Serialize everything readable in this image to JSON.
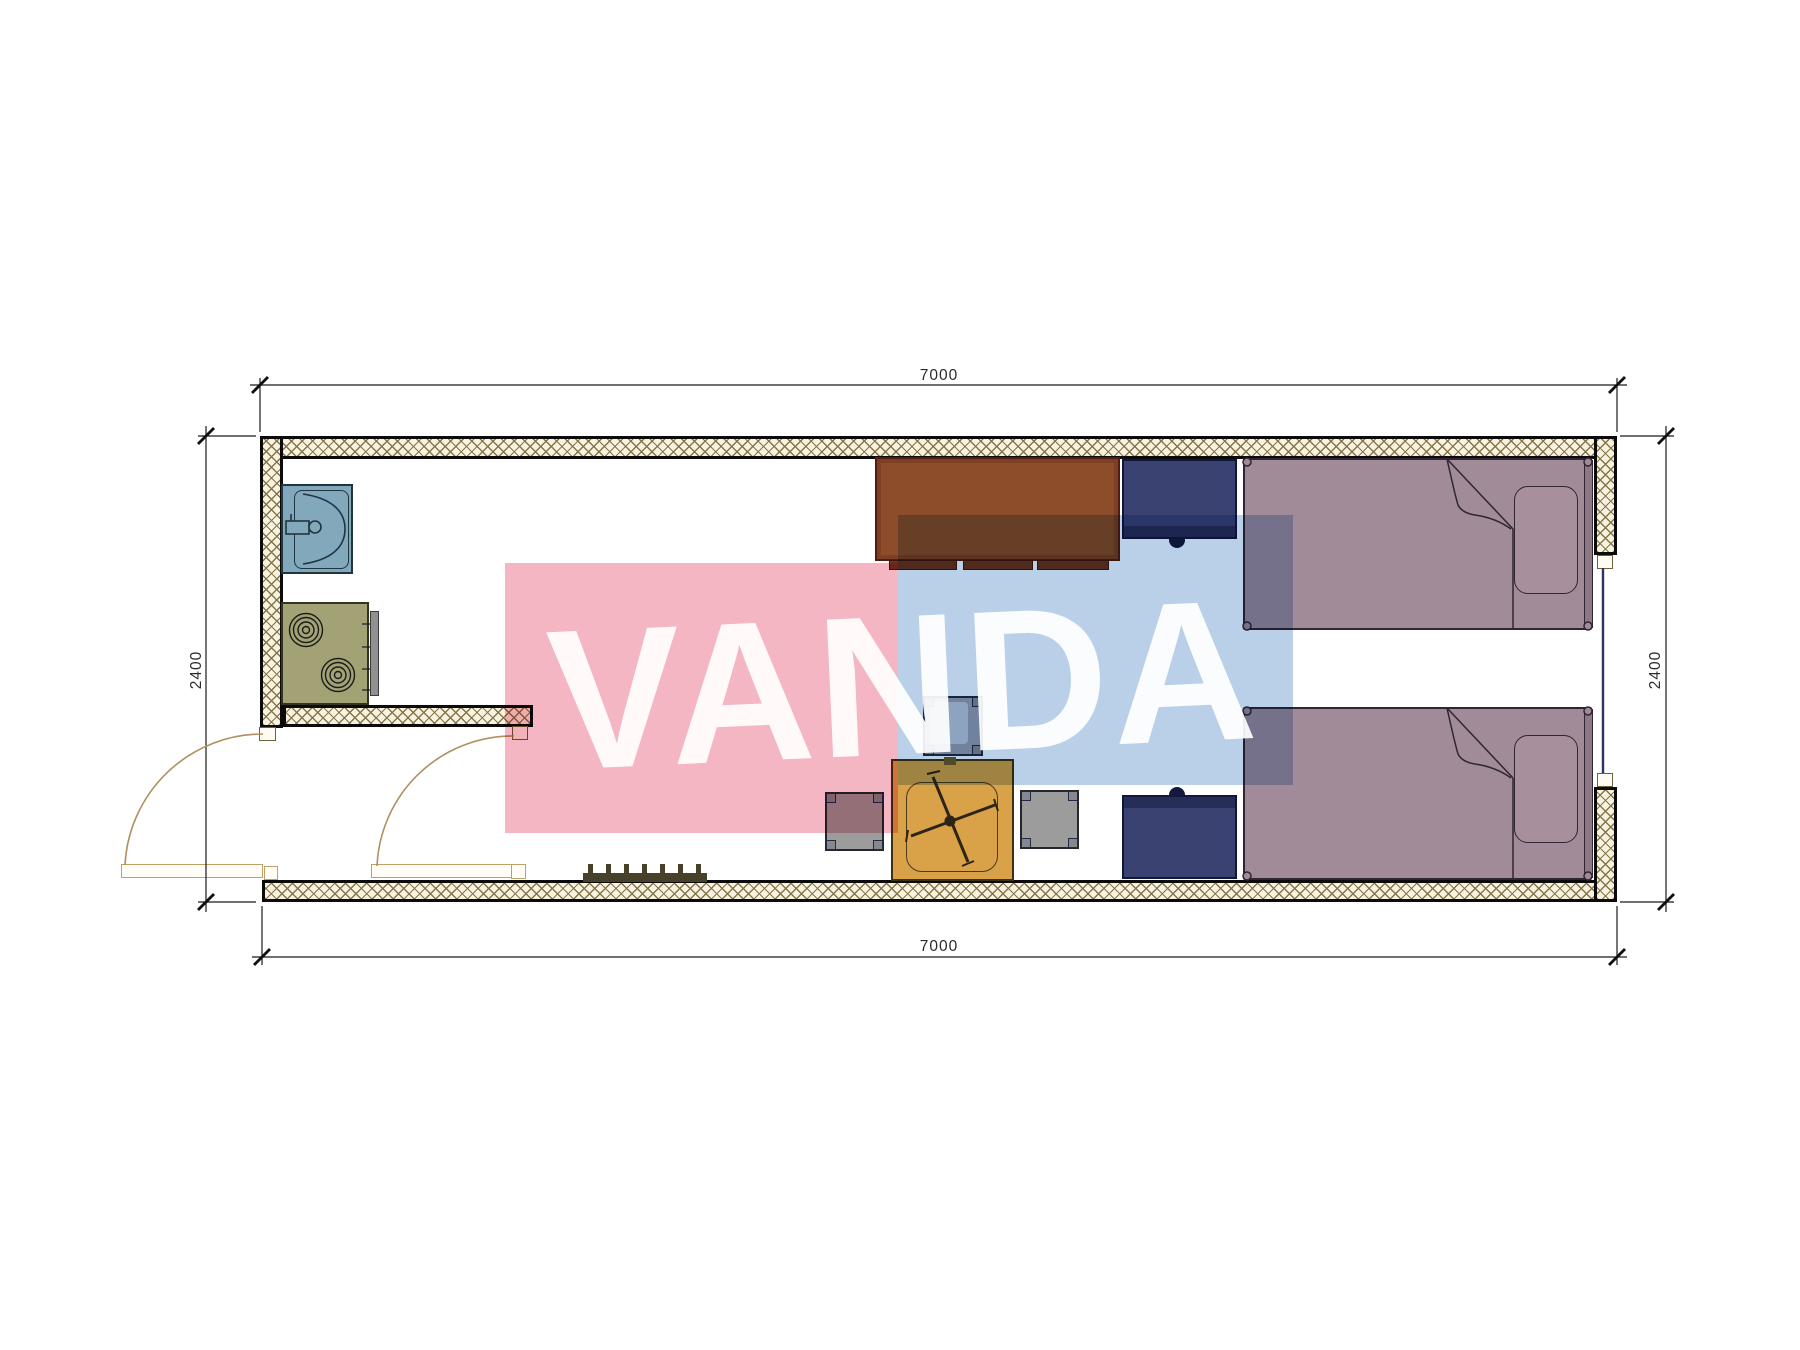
{
  "document": {
    "type": "architectural floor plan",
    "room_outer_mm": "7000 x 2400"
  },
  "dimensions": {
    "top": "7000",
    "bottom": "7000",
    "left": "2400",
    "right": "2400"
  },
  "watermark": {
    "text": "VANDA",
    "pink_color": "#f4b6c2",
    "blue_color": "#bad0e8",
    "text_color": "#ffffff"
  },
  "furniture_symbols": [
    "sink",
    "stove",
    "towel-grill",
    "kitchen-partition-wall",
    "exterior-door-left",
    "exterior-door-bottom",
    "shoe-grate",
    "desk",
    "desk-side-cabinet",
    "night-cabinet",
    "bed-top",
    "bed-bottom",
    "square-chair",
    "stool-left",
    "stool-right",
    "coffee-table-folded",
    "window-right"
  ],
  "colors": {
    "wall_hatch_line": "#877549",
    "wall_fill": "#f8f2e1",
    "wall_border": "#0b0b0b",
    "sink": "#82a8bc",
    "stove": "#a3a274",
    "desk": "#8d4d2b",
    "navy_furniture": "#3a4272",
    "bed": "#a28b99",
    "stool": "#9c9c9c",
    "coffee_table": "#d9a148",
    "door_line": "#b09060",
    "window_line": "#2a3560",
    "dimension_line": "#1a1a1a"
  }
}
